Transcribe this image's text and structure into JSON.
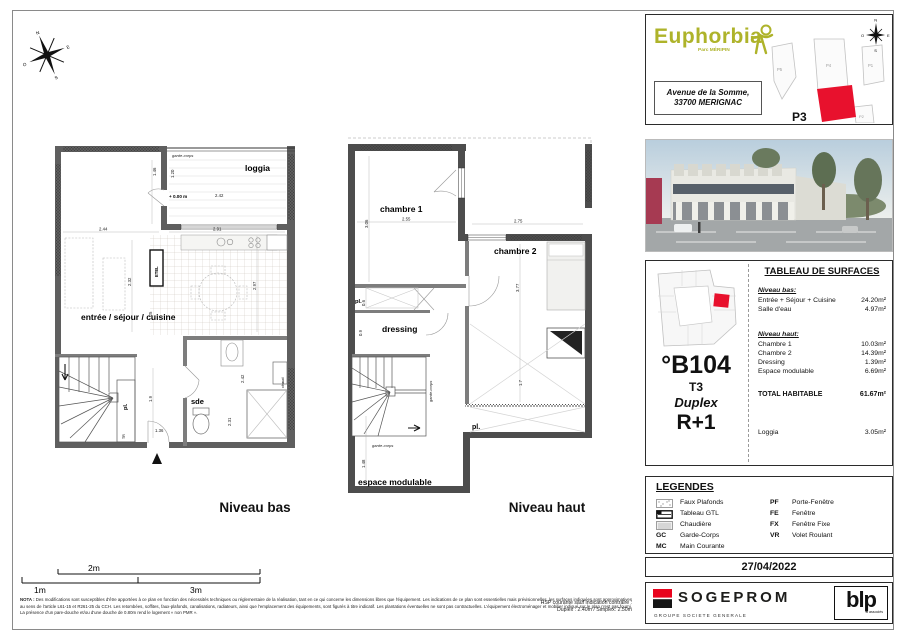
{
  "colors": {
    "accent_red": "#e8112d",
    "logo_olive": "#aeb32a",
    "wall_gray": "#5f5f5f"
  },
  "compass": {
    "n": "N",
    "s": "S",
    "e": "E",
    "o": "O"
  },
  "plans": {
    "bas": {
      "title": "Niveau bas",
      "labels": {
        "garde_corps": "garde-corps",
        "loggia": "loggia",
        "level": "+ 0.00 m",
        "sejour": "entrée / séjour / cuisine",
        "sde": "sde",
        "pl": "pl.",
        "etel": "ETEL",
        "chaud": "chaud",
        "tr": "TR"
      },
      "dims": {
        "d146": "1.46",
        "d120": "1.20",
        "d242a": "2.42",
        "d244": "2.44",
        "d291": "2.91",
        "d232": "2.32",
        "d297": "2.97",
        "d125": "1.25",
        "d19": "1.9",
        "d136": "1.36",
        "d231": "2.31",
        "d242b": "2.42"
      }
    },
    "haut": {
      "title": "Niveau haut",
      "labels": {
        "ch1": "chambre 1",
        "ch2": "chambre 2",
        "dressing": "dressing",
        "pl_top": "pl.",
        "pl_mid": "pl.",
        "esp": "espace modulable",
        "gc_side": "garde-corps",
        "gc_bottom": "garde-corps"
      },
      "dims": {
        "d306": "3.06",
        "d255": "2.55",
        "d275": "2.75",
        "d377": "3.77",
        "d06": "0.6",
        "d09": "0.9",
        "d148": "1.48",
        "d17": "1.7"
      }
    }
  },
  "project": {
    "name": "Euphorbia",
    "subtitle": "Parc MÉRIPIN",
    "address_line1": "Avenue  de la Somme,",
    "address_line2": "33700 MERIGNAC",
    "siteplan": {
      "p5": "P5",
      "p4": "P4",
      "p1": "P1",
      "p2": "P2",
      "p3": "P3"
    }
  },
  "unit": {
    "number": "°B104",
    "type": "T3",
    "style": "Duplex",
    "level": "R+1"
  },
  "surfaces": {
    "title": "TABLEAU DE SURFACES",
    "groups": [
      {
        "heading": "Niveau bas:",
        "rows": [
          {
            "label": "Entrée + Séjour + Cuisine",
            "value": "24.20m²"
          },
          {
            "label": "Salle d'eau",
            "value": "4.97m²"
          }
        ]
      },
      {
        "heading": "Niveau haut:",
        "rows": [
          {
            "label": "Chambre 1",
            "value": "10.03m²"
          },
          {
            "label": "Chambre 2",
            "value": "14.39m²"
          },
          {
            "label": "Dressing",
            "value": "1.39m²"
          },
          {
            "label": "Espace modulable",
            "value": "6.69m²"
          }
        ]
      }
    ],
    "total_label": "TOTAL HABITABLE",
    "total_value": "61.67m²",
    "loggia_label": "Loggia",
    "loggia_value": "3.05m²"
  },
  "legend": {
    "title": "LEGENDES",
    "left": [
      {
        "abbr": "",
        "label": "Faux Plafonds"
      },
      {
        "abbr": "",
        "label": "Tableau GTL"
      },
      {
        "abbr": "",
        "label": "Chaudière"
      },
      {
        "abbr": "GC",
        "label": "Garde-Corps"
      },
      {
        "abbr": "MC",
        "label": "Main Courante"
      }
    ],
    "right": [
      {
        "abbr": "PF",
        "label": "Porte-Fenêtre"
      },
      {
        "abbr": "FE",
        "label": "Fenêtre"
      },
      {
        "abbr": "FX",
        "label": "Fenêtre Fixe"
      },
      {
        "abbr": "VR",
        "label": "Volet Roulant"
      }
    ]
  },
  "date": "27/04/2022",
  "branding": {
    "sogeprom": "SOGEPROM",
    "sogeprom_sub": "GROUPE SOCIETE GENERALE",
    "blp": "blp",
    "blp_sub": "& associés"
  },
  "scalebar": {
    "m1": "1m",
    "m2": "2m",
    "m3": "3m"
  },
  "nota": {
    "prefix": "NOTA :",
    "body": " Des modifications sont susceptibles d'être apportées à ce plan en fonction des nécessités techniques ou réglementaire de la réalisation, tant en ce qui concerne les dimensions libres que l'équipement. Les indications de ce plan sont essentielles mais prévisionnelles, les surfaces indiquées sont approximatives au sens de l'article L61-15 et R261-25 du CCH. Les retombées, soffites, faux-plafonds, canalisations, radiateurs, ainsi que l'emplacement des équipements, sont figurés à titre indicatif. Les plantations éventuelles ne sont pas contractuelles. L'équipement électroménager et mobilier indiqué sur le plan n'est pas fourni. La présence d'un pare-douche et/ou d'une douche de 0.80m rend le logement « non PMR ».",
    "hsp1": "HSP courante sauf indication contraire :",
    "hsp2": "Duplex : 2.40m / Simplex: 2.50m"
  }
}
